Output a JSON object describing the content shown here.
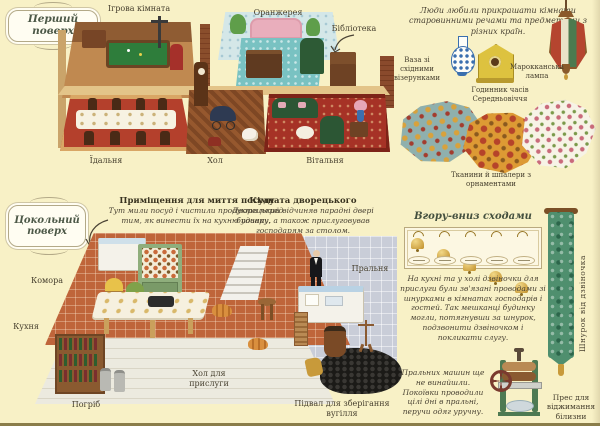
{
  "frames": {
    "upper": "Перший поверх",
    "basement": "Цокольний поверх"
  },
  "upper_floor": {
    "rooms": {
      "game": "Ігрова кімната",
      "orangery": "Оранжерея",
      "library": "Бібліотека",
      "dining": "Їдальня",
      "hall": "Хол",
      "living": "Вітальня"
    }
  },
  "basement_floor": {
    "rooms": {
      "pantry": "Комора",
      "kitchen": "Кухня",
      "cellar": "Погріб",
      "servants_hall": "Хол для прислуги",
      "laundry": "Пральня",
      "coal": "Підвал для зберігання вугілля"
    }
  },
  "callouts": {
    "scullery_title": "Приміщення для миття посуду",
    "scullery_body": "Тут мили посуд і чистили продукти перед тим, як винести їх на кухню повару.",
    "butler_title": "Кімната дворецького",
    "butler_body": "Дворецький відчиняв парадні двері будинку, а також прислуговував господарям за столом."
  },
  "decor": {
    "intro": "Люди любили прикрашати кімнати старовинними речами та предметами з різних країн.",
    "vase_label": "Ваза зі східними візерунками",
    "clock_label": "Годинник часів Середньовіччя",
    "lamp_label": "Марокканська лампа",
    "fabrics_label": "Тканини й шпалери з орнаментами"
  },
  "bells": {
    "title": "Вгору-вниз сходами",
    "body": "На кухні та у холі дзвіночки для прислуги були зв'язані проводами зі шнурками в кімнатах господарів і гостей. Так мешканці будинку могли, потягнувши за шнурок, подзвонити дзвіночком і покликати слугу.",
    "cord_label": "Шнурок від дзвіночка"
  },
  "laundry_note": {
    "body": "Пральних машин ще не винайшли. Покоївки проводили цілі дні в пральні, перучи одяг уручну.",
    "press_label": "Прес для віджимання білизни"
  },
  "colors": {
    "background": "#f8f1c6",
    "banner_green": "#4f8f6e",
    "bell_gold": "#d7a93c",
    "rug_red": "#a63226",
    "tile_terracotta": "#bf653a"
  }
}
